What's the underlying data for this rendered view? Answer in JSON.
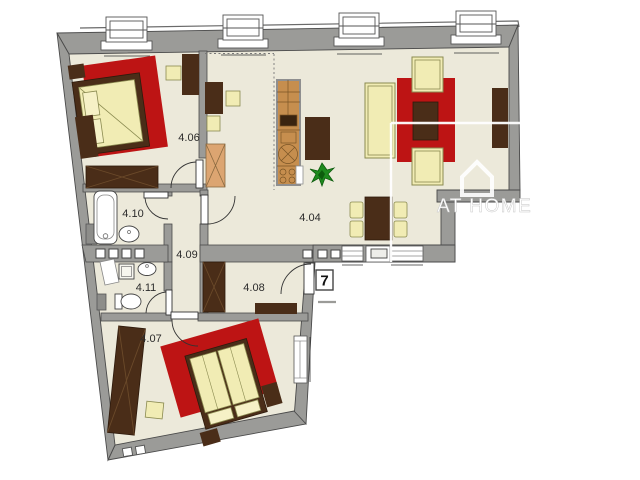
{
  "plan": {
    "rooms": {
      "r404": "4.04",
      "r406": "4.06",
      "r407": "4.07",
      "r408": "4.08",
      "r409": "4.09",
      "r410": "4.10",
      "r411": "4.11"
    },
    "unit_number": "7",
    "watermark_text": "AT HOME",
    "colors": {
      "floor": "#ece9da",
      "wall": "#9b9b98",
      "accent_red": "#bd1414",
      "furniture_dark": "#4a2d18",
      "furniture_cream": "#f1ecb4",
      "kitchen_wood": "#c68e4e",
      "cabinet_tan": "#dca571",
      "plant_green": "#1e8a1e",
      "watermark": "#ffffff"
    }
  }
}
